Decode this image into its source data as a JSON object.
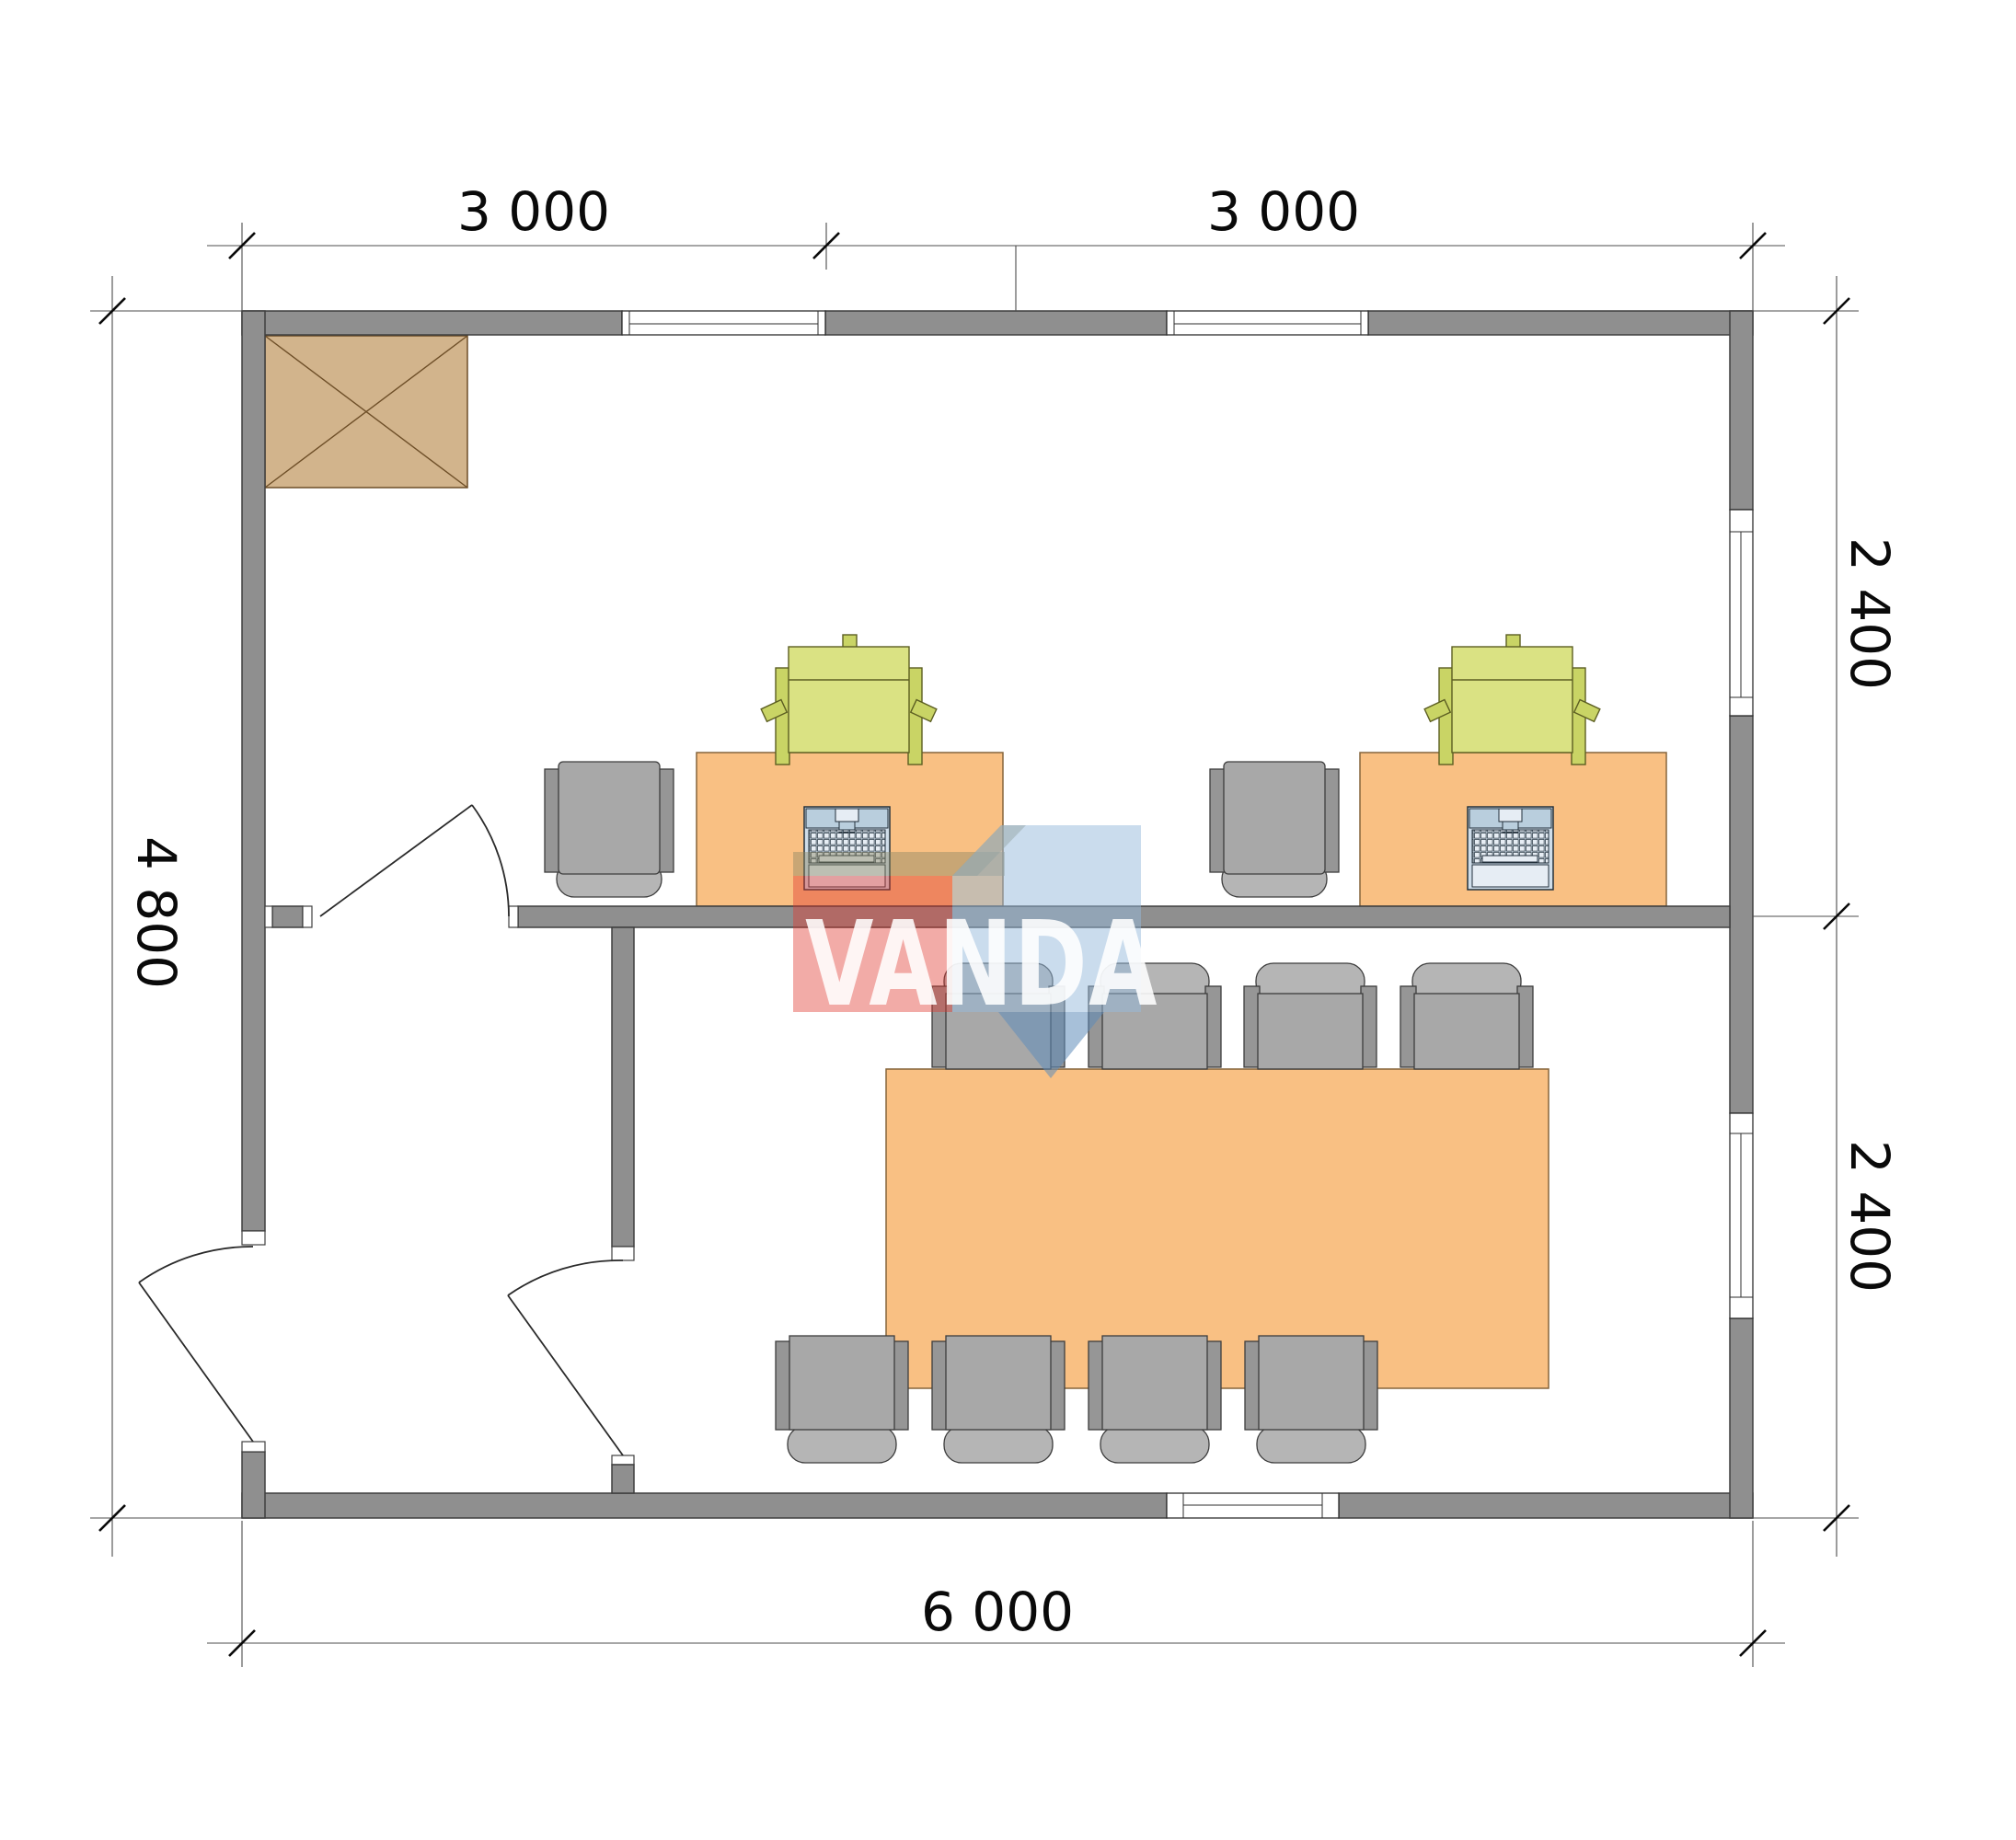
{
  "drawing": {
    "type": "floor-plan",
    "units": "mm"
  },
  "dimensions": {
    "top": [
      "3 000",
      "3 000"
    ],
    "right": [
      "2 400",
      "2 400"
    ],
    "left": "4 800",
    "bottom": "6 000"
  },
  "watermark": {
    "text": "VANDA"
  },
  "inventory": {
    "desks": 2,
    "desk_chairs": 2,
    "printers": 2,
    "laptops": 2,
    "meeting_table": 1,
    "meeting_chairs": 8,
    "cabinet": 1,
    "doors": 3,
    "windows": 5
  },
  "colors": {
    "wall": "#8f8f8f",
    "wallStroke": "#3f3f3f",
    "desk": "#f9c083",
    "deskStroke": "#86653c",
    "chair": "#a8a8a8",
    "chairBack": "#b5b5b5",
    "chairArm": "#969696",
    "printer": "#dae283",
    "printerDark": "#c9d465",
    "laptop": "#cfdde9",
    "cabinet": "#d2b48c",
    "wmRed": "rgba(225,55,45,0.42)",
    "wmBlueLight": "rgba(150,185,220,0.50)",
    "wmBlueMid": "rgba(95,140,185,0.55)",
    "wmKhaki": "rgba(140,135,100,0.45)",
    "wmText": "rgba(255,255,255,0.88)"
  }
}
